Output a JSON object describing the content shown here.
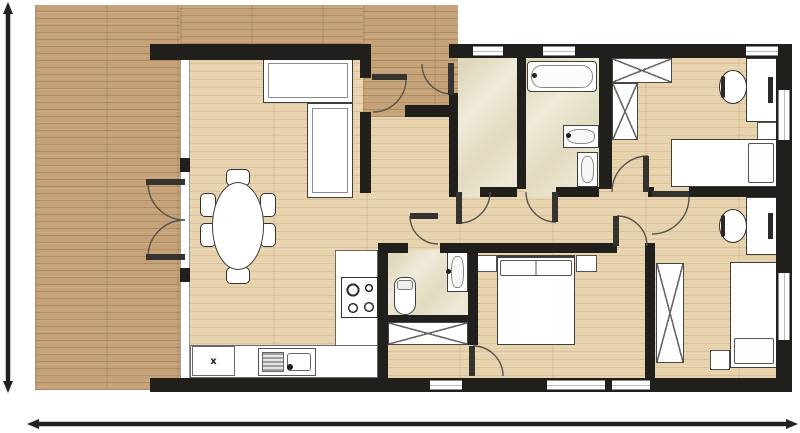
{
  "title": "apartment-floor-plan",
  "palette": {
    "wall": "#211f1c",
    "deck_wood": "#c5a277",
    "interior_wood": "#e7d3ae",
    "tile": "#eae4cd",
    "furniture_fill": "#ffffff",
    "furniture_outline": "#403e3a",
    "dimension_line": "#23211e"
  },
  "labels": {
    "appliance": "x"
  },
  "regions": [
    {
      "name": "floor-main",
      "cls": "wood-floor",
      "x": 180,
      "y": 44,
      "w": 600,
      "h": 340
    },
    {
      "name": "deck-left",
      "cls": "wood-deck",
      "x": 35,
      "y": 5,
      "w": 145,
      "h": 385
    },
    {
      "name": "deck-top-strip",
      "cls": "wood-deck",
      "x": 180,
      "y": 5,
      "w": 183,
      "h": 39
    },
    {
      "name": "deck-entry-porch",
      "cls": "wood-deck",
      "x": 363,
      "y": 5,
      "w": 95,
      "h": 112
    },
    {
      "name": "tile-entry-hall",
      "cls": "tile",
      "x": 458,
      "y": 58,
      "w": 59,
      "h": 139
    },
    {
      "name": "tile-bathroom",
      "cls": "tile",
      "x": 526,
      "y": 58,
      "w": 73,
      "h": 139
    },
    {
      "name": "tile-wc",
      "cls": "tile",
      "x": 388,
      "y": 250,
      "w": 80,
      "h": 65
    },
    {
      "name": "glass-wall-living",
      "cls": "glass",
      "x": 180,
      "y": 58,
      "w": 10,
      "h": 320
    }
  ],
  "walls": [
    {
      "name": "wall-top-left",
      "x": 150,
      "y": 44,
      "w": 213,
      "h": 16
    },
    {
      "name": "wall-top-right",
      "x": 449,
      "y": 44,
      "w": 343,
      "h": 14
    },
    {
      "name": "wall-right",
      "x": 776,
      "y": 44,
      "w": 16,
      "h": 348
    },
    {
      "name": "wall-bottom",
      "x": 150,
      "y": 378,
      "w": 642,
      "h": 14
    },
    {
      "name": "wall-living-right-upper",
      "x": 360,
      "y": 44,
      "w": 11,
      "h": 34
    },
    {
      "name": "wall-living-right-lower",
      "x": 360,
      "y": 112,
      "w": 11,
      "h": 81
    },
    {
      "name": "wall-porch-stub",
      "x": 405,
      "y": 105,
      "w": 44,
      "h": 12
    },
    {
      "name": "wall-entry-left",
      "x": 449,
      "y": 93,
      "w": 9,
      "h": 104
    },
    {
      "name": "wall-entry-bath-divider",
      "x": 517,
      "y": 58,
      "w": 9,
      "h": 131
    },
    {
      "name": "wall-bath-bedroom-divider",
      "x": 599,
      "y": 44,
      "w": 13,
      "h": 145
    },
    {
      "name": "wall-hall-seg-a",
      "x": 480,
      "y": 187,
      "w": 37,
      "h": 10
    },
    {
      "name": "wall-hall-seg-b",
      "x": 556,
      "y": 187,
      "w": 43,
      "h": 10
    },
    {
      "name": "wall-hall-seg-c",
      "x": 648,
      "y": 187,
      "w": 6,
      "h": 10
    },
    {
      "name": "wall-hall-seg-d",
      "x": 689,
      "y": 187,
      "w": 89,
      "h": 10
    },
    {
      "name": "wall-corridor-a",
      "x": 378,
      "y": 243,
      "w": 30,
      "h": 10
    },
    {
      "name": "wall-corridor-b",
      "x": 440,
      "y": 243,
      "w": 177,
      "h": 10
    },
    {
      "name": "wall-corridor-stub",
      "x": 647,
      "y": 243,
      "w": 8,
      "h": 10
    },
    {
      "name": "wall-kitchen-wc",
      "x": 378,
      "y": 243,
      "w": 10,
      "h": 135
    },
    {
      "name": "wall-wc-bottom",
      "x": 378,
      "y": 315,
      "w": 100,
      "h": 7
    },
    {
      "name": "wall-master-left",
      "x": 468,
      "y": 243,
      "w": 10,
      "h": 102
    },
    {
      "name": "wall-master-right",
      "x": 645,
      "y": 243,
      "w": 10,
      "h": 135
    },
    {
      "name": "glass-post-upper",
      "x": 180,
      "y": 158,
      "w": 10,
      "h": 14
    },
    {
      "name": "glass-post-lower",
      "x": 180,
      "y": 268,
      "w": 10,
      "h": 14
    }
  ],
  "windows": [
    {
      "name": "window-top-1",
      "cls": "window-h",
      "x": 473,
      "y": 46,
      "w": 30,
      "h": 10
    },
    {
      "name": "window-top-2",
      "cls": "window-h",
      "x": 543,
      "y": 46,
      "w": 32,
      "h": 10
    },
    {
      "name": "window-top-3",
      "cls": "window-h",
      "x": 746,
      "y": 46,
      "w": 32,
      "h": 10
    },
    {
      "name": "window-right-1",
      "cls": "window-v",
      "x": 778,
      "y": 90,
      "w": 12,
      "h": 50
    },
    {
      "name": "window-right-2",
      "cls": "window-v",
      "x": 778,
      "y": 273,
      "w": 12,
      "h": 67
    },
    {
      "name": "window-bottom-1",
      "cls": "window-h",
      "x": 430,
      "y": 380,
      "w": 32,
      "h": 10
    },
    {
      "name": "window-bottom-2",
      "cls": "window-h",
      "x": 547,
      "y": 380,
      "w": 58,
      "h": 10
    },
    {
      "name": "window-bottom-3",
      "cls": "window-h",
      "x": 612,
      "y": 380,
      "w": 38,
      "h": 10
    }
  ],
  "furniture": [
    {
      "name": "sofa-back-section",
      "cls": "sofa",
      "x": 263,
      "y": 58,
      "w": 90,
      "h": 45
    },
    {
      "name": "sofa-side-section",
      "cls": "sofa",
      "x": 307,
      "y": 103,
      "w": 46,
      "h": 95
    },
    {
      "name": "dining-chair-top",
      "cls": "chair-sm",
      "x": 226,
      "y": 169,
      "w": 24,
      "h": 17
    },
    {
      "name": "dining-chair-bottom",
      "cls": "chair-sm",
      "x": 226,
      "y": 267,
      "w": 24,
      "h": 17
    },
    {
      "name": "dining-chair-left-1",
      "cls": "chair-sm",
      "x": 200,
      "y": 193,
      "w": 16,
      "h": 24
    },
    {
      "name": "dining-chair-left-2",
      "cls": "chair-sm",
      "x": 200,
      "y": 223,
      "w": 16,
      "h": 24
    },
    {
      "name": "dining-chair-right-1",
      "cls": "chair-sm",
      "x": 260,
      "y": 193,
      "w": 16,
      "h": 24
    },
    {
      "name": "dining-chair-right-2",
      "cls": "chair-sm",
      "x": 260,
      "y": 223,
      "w": 16,
      "h": 24
    },
    {
      "name": "dining-table",
      "cls": "dining-table",
      "x": 212,
      "y": 182,
      "w": 52,
      "h": 88
    },
    {
      "name": "kitchen-island-counter",
      "cls": "counter",
      "x": 335,
      "y": 250,
      "w": 43,
      "h": 128
    },
    {
      "name": "kitchen-bottom-counter",
      "cls": "counter",
      "x": 190,
      "y": 345,
      "w": 188,
      "h": 33
    },
    {
      "name": "stove",
      "cls": "stove",
      "x": 341,
      "y": 277,
      "w": 37,
      "h": 41
    },
    {
      "name": "kitchen-sink",
      "cls": "sink",
      "x": 258,
      "y": 348,
      "w": 58,
      "h": 28
    },
    {
      "name": "sink-faucet",
      "cls": "dot",
      "x": 287,
      "y": 364,
      "w": 6,
      "h": 6
    },
    {
      "name": "dishwasher",
      "cls": "counter",
      "x": 192,
      "y": 346,
      "w": 43,
      "h": 30
    },
    {
      "name": "wc-toilet",
      "cls": "toilet",
      "x": 394,
      "y": 277,
      "w": 22,
      "h": 38
    },
    {
      "name": "wc-washbasin",
      "cls": "basin",
      "x": 447,
      "y": 252,
      "w": 21,
      "h": 40
    },
    {
      "name": "wc-basin-tap",
      "cls": "dot",
      "x": 446,
      "y": 269,
      "w": 5,
      "h": 5
    },
    {
      "name": "hall-wardrobe",
      "cls": "x-cross",
      "x": 388,
      "y": 322,
      "w": 80,
      "h": 23
    },
    {
      "name": "bathtub",
      "cls": "bathtub",
      "x": 527,
      "y": 61,
      "w": 70,
      "h": 31
    },
    {
      "name": "bathtub-tap",
      "cls": "dot",
      "x": 532,
      "y": 73,
      "w": 5,
      "h": 5
    },
    {
      "name": "bathroom-washbasin",
      "cls": "basin",
      "x": 563,
      "y": 125,
      "w": 36,
      "h": 23
    },
    {
      "name": "bathroom-basin-tap",
      "cls": "dot",
      "x": 566,
      "y": 133,
      "w": 5,
      "h": 5
    },
    {
      "name": "bathroom-toilet",
      "cls": "basin",
      "x": 577,
      "y": 152,
      "w": 21,
      "h": 35
    },
    {
      "name": "bedroom1-wardrobe-top",
      "cls": "x-cross",
      "x": 612,
      "y": 58,
      "w": 60,
      "h": 25
    },
    {
      "name": "bedroom1-wardrobe-side",
      "cls": "x-cross",
      "x": 612,
      "y": 83,
      "w": 26,
      "h": 57
    },
    {
      "name": "bedroom1-desk",
      "cls": "desk",
      "x": 746,
      "y": 58,
      "w": 32,
      "h": 64
    },
    {
      "name": "bedroom1-chair",
      "cls": "chair-desk",
      "x": 719,
      "y": 70,
      "w": 28,
      "h": 34
    },
    {
      "name": "bedroom1-nightstand",
      "cls": "nightstand",
      "x": 757,
      "y": 122,
      "w": 22,
      "h": 18
    },
    {
      "name": "bedroom1-bed",
      "cls": "bed pillow-right",
      "x": 671,
      "y": 139,
      "w": 107,
      "h": 48
    },
    {
      "name": "master-nightstand-left",
      "cls": "nightstand",
      "x": 477,
      "y": 255,
      "w": 20,
      "h": 17
    },
    {
      "name": "master-nightstand-right",
      "cls": "nightstand",
      "x": 576,
      "y": 255,
      "w": 21,
      "h": 17
    },
    {
      "name": "master-bed",
      "cls": "bed bed-double",
      "x": 497,
      "y": 255,
      "w": 78,
      "h": 90
    },
    {
      "name": "bedroom2-desk",
      "cls": "desk",
      "x": 746,
      "y": 197,
      "w": 32,
      "h": 58
    },
    {
      "name": "bedroom2-chair",
      "cls": "chair-desk",
      "x": 719,
      "y": 209,
      "w": 28,
      "h": 34
    },
    {
      "name": "bedroom2-wardrobe",
      "cls": "x-cross",
      "x": 656,
      "y": 263,
      "w": 28,
      "h": 100
    },
    {
      "name": "bedroom2-bed",
      "cls": "bed pillow-bottom",
      "x": 730,
      "y": 262,
      "w": 48,
      "h": 106
    },
    {
      "name": "bedroom2-nightstand",
      "cls": "nightstand",
      "x": 710,
      "y": 350,
      "w": 20,
      "h": 20
    }
  ],
  "doors": [
    {
      "name": "door-french-upper",
      "leaf": [
        146,
        179,
        39,
        6
      ],
      "c": [
        185,
        183
      ],
      "r": 37,
      "a0": 180,
      "a1": 90,
      "sweep": 0
    },
    {
      "name": "door-french-lower",
      "leaf": [
        146,
        254,
        39,
        6
      ],
      "c": [
        185,
        257
      ],
      "r": 37,
      "a0": 180,
      "a1": 270,
      "sweep": 1
    },
    {
      "name": "door-living-porch",
      "leaf": [
        372,
        74,
        35,
        6
      ],
      "c": [
        373,
        79
      ],
      "r": 33,
      "a0": 0,
      "a1": 90,
      "sweep": 1
    },
    {
      "name": "door-main-entry",
      "leaf": [
        448,
        63,
        6,
        32
      ],
      "c": [
        452,
        64
      ],
      "r": 30,
      "a0": 90,
      "a1": 180,
      "sweep": 1
    },
    {
      "name": "door-entry-hall",
      "leaf": [
        456,
        192,
        6,
        32
      ],
      "c": [
        459,
        192
      ],
      "r": 31,
      "a0": 90,
      "a1": 0,
      "sweep": 0
    },
    {
      "name": "door-bathroom",
      "leaf": [
        552,
        192,
        6,
        30
      ],
      "c": [
        556,
        192
      ],
      "r": 30,
      "a0": 180,
      "a1": 90,
      "sweep": 0
    },
    {
      "name": "door-wc",
      "leaf": [
        410,
        213,
        28,
        6
      ],
      "c": [
        438,
        216
      ],
      "r": 28,
      "a0": 180,
      "a1": 90,
      "sweep": 0
    },
    {
      "name": "door-bedroom1",
      "leaf": [
        643,
        156,
        6,
        36
      ],
      "c": [
        648,
        192
      ],
      "r": 36,
      "a0": 270,
      "a1": 180,
      "sweep": 0
    },
    {
      "name": "door-master",
      "leaf": [
        613,
        216,
        6,
        30
      ],
      "c": [
        617,
        246
      ],
      "r": 30,
      "a0": 0,
      "a1": 270,
      "sweep": 0
    },
    {
      "name": "door-bedroom2",
      "leaf": [
        652,
        191,
        37,
        6
      ],
      "c": [
        652,
        197
      ],
      "r": 37,
      "a0": 90,
      "a1": 0,
      "sweep": 0
    },
    {
      "name": "door-master-closet",
      "leaf": [
        469,
        346,
        6,
        30
      ],
      "c": [
        473,
        376
      ],
      "r": 30,
      "a0": 270,
      "a1": 0,
      "sweep": 1
    }
  ],
  "dimensions": {
    "vertical": {
      "x": 8,
      "y1": 8,
      "y2": 387
    },
    "horizontal": {
      "y": 424,
      "x1": 33,
      "x2": 792
    }
  }
}
